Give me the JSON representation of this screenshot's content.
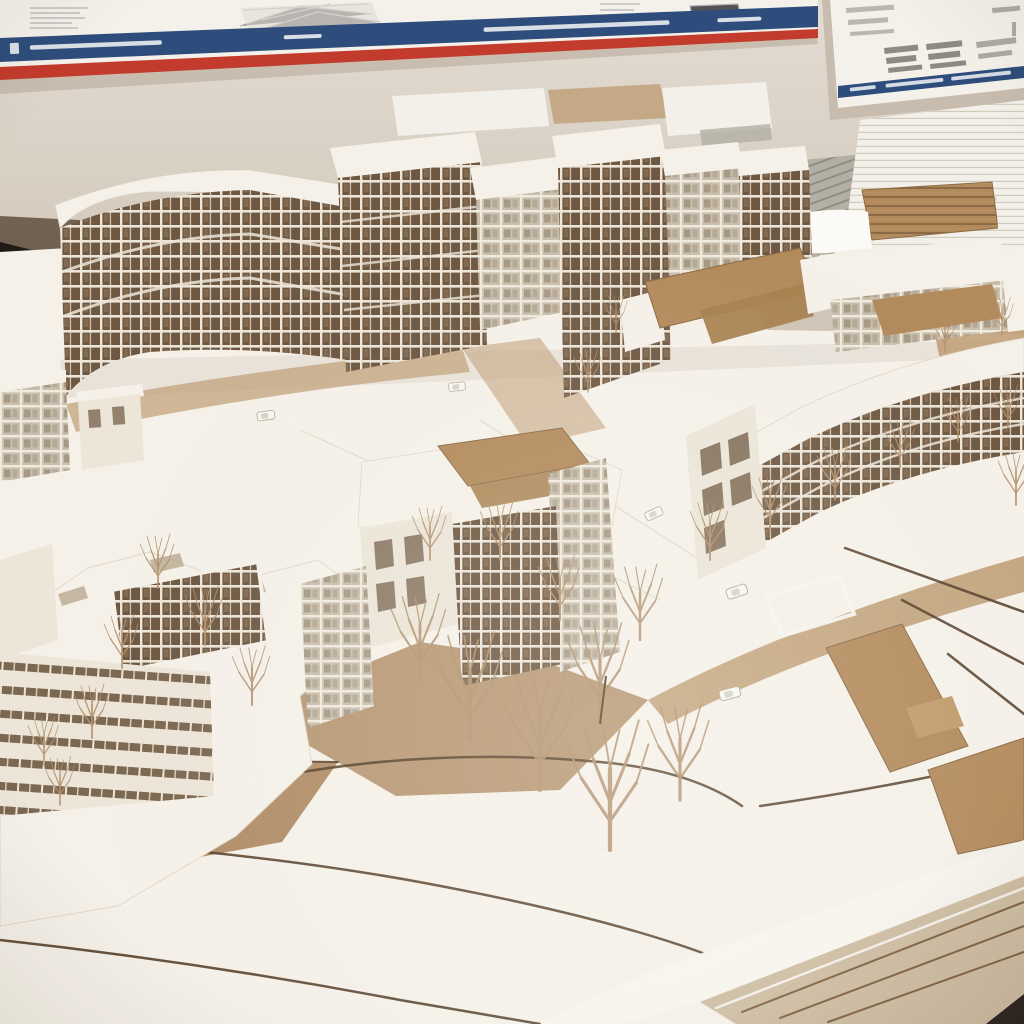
{
  "scene": {
    "subject": "Photograph of a cardboard architectural scale model of a residential district on a studio table",
    "environment": "Studio wall with two pinned presentation boards; stacks of white sheets and cardboard blanks behind the model"
  },
  "palette": {
    "wallTop": "#e3dcd2",
    "wallBottom": "#ccc1b2",
    "posterPaper": "#f4f1ea",
    "posterBlue": "#2e4d7c",
    "posterRed": "#c23b2c",
    "sketch": "#8f9296",
    "paper": "#f3f0e9",
    "paperShade": "#d9d2c4",
    "cardboard": "#b38a5c",
    "cardboardEdge": "#7e5f3d",
    "grayStack": "#b3afa5",
    "modelWhite": "#f5f1e9",
    "modelShade": "#e4dccd",
    "ground": "#c1a17a",
    "mdf": "#b08d66",
    "contour": "#57402a",
    "facade": "#a98a63",
    "windowDark": "#6e5842",
    "mullion": "#ece5d8",
    "glass": "#c9bfae",
    "tree": "#b2926f",
    "dark": "#1f1b17",
    "tableEdge": "#29231d"
  },
  "posters": {
    "left": {
      "label": "presentation board with blue and red title stripes and small illegible print",
      "caption_legible": false
    },
    "right": {
      "label": "presentation board with axonometric sketches and blue footer strip",
      "caption_legible": false
    }
  },
  "background": {
    "stacks_label": "stacks of white sheets, grey boards and cardboard blanks on the table"
  },
  "model": {
    "back_row_label": "back row of six-to-eight storey apartment slabs in card and wood",
    "right_slab_label": "long curved four-storey slab with white roof",
    "center_block_label": "courtyard mid-rise with cardboard roof patch and wire trees",
    "left_block_label": "stepped perimeter block with large white roof",
    "foreground_label": "white contour terraces over MDF base with laser-cut edges",
    "props": {
      "cars": "small white model cars",
      "trees": "bare wire trees"
    }
  }
}
